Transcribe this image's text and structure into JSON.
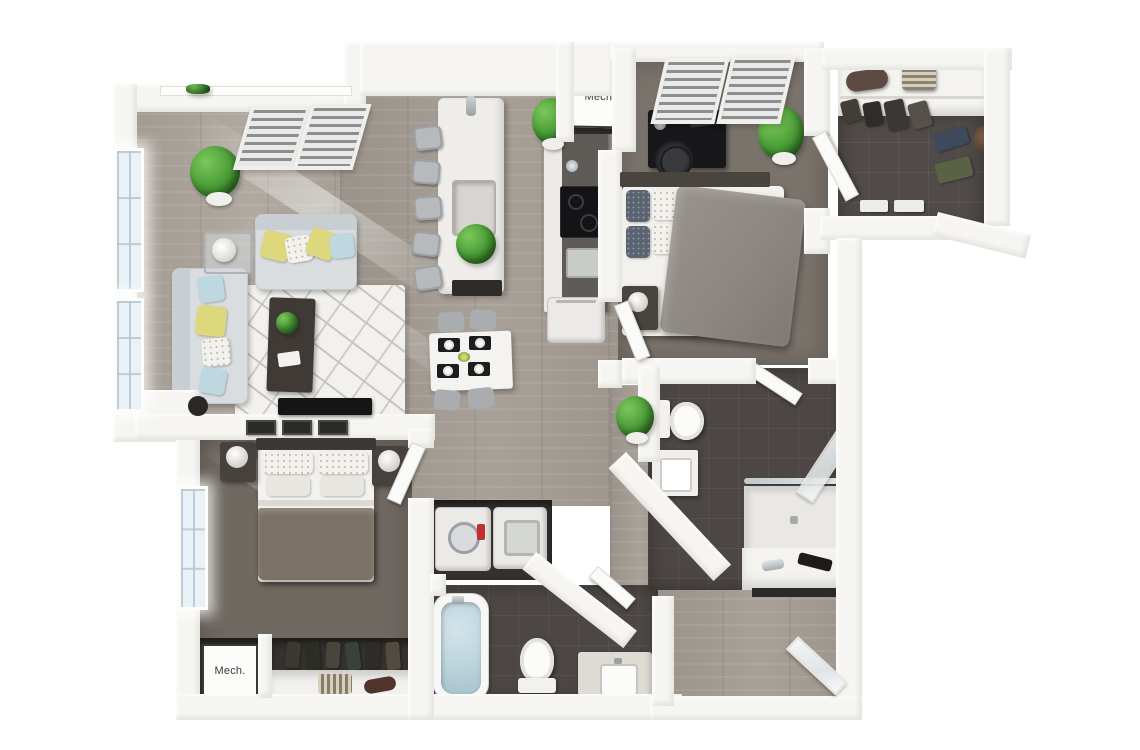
{
  "scene": {
    "kind": "3d-floor-plan-render",
    "view": "top-down dollhouse"
  },
  "labels": {
    "mech_upper": "Mech.",
    "mech_lower": "Mech."
  },
  "palette": {
    "background": "#ffffff",
    "walls": "#f6f5f2",
    "wood_floor": "#a49c93",
    "bedroom_carpet": "#746d65",
    "bathroom_tile": "#4c4744",
    "closet_niche": "#34312e",
    "sofa_gray": "#d9dde0",
    "pillow_yellow": "#ddd87c",
    "pillow_blue": "#bdd8e0",
    "plant_green": "#479a35",
    "tub_water": "#b9d2da",
    "bed_blanket_brown": "#7b7165",
    "duvet_gray": "#8d8781",
    "desk_black": "#18171a"
  },
  "rooms": [
    {
      "name": "living-room",
      "items": [
        "sofa",
        "loveseat",
        "area-rug",
        "coffee-table",
        "side-table-with-lamp",
        "tv-console",
        "potted-plant",
        "blinded-window",
        "tall-windows"
      ]
    },
    {
      "name": "kitchen",
      "items": [
        "island-with-sink",
        "island-plant",
        "five-bar-stools",
        "cooktop-counter",
        "counter-sink",
        "refrigerator",
        "potted-plant"
      ]
    },
    {
      "name": "dining-area",
      "items": [
        "table",
        "four-chairs",
        "four-place-settings",
        "centerpiece"
      ]
    },
    {
      "name": "bedroom-primary-bottom-left",
      "items": [
        "bed-with-brown-blanket",
        "two-nightstands",
        "two-lamps",
        "three-wall-frames",
        "window",
        "reach-in-closet"
      ]
    },
    {
      "name": "bedroom-top-right",
      "items": [
        "bed-with-gray-duvet",
        "desk",
        "office-chair",
        "nightstand-with-lamp",
        "blinded-window",
        "potted-plant"
      ]
    },
    {
      "name": "walk-in-closet",
      "items": [
        "hanging-clothes",
        "shelf-with-bags",
        "striped-basket",
        "storage-bins"
      ]
    },
    {
      "name": "bathroom-bottom",
      "items": [
        "bathtub",
        "toilet",
        "vanity-with-sink",
        "bath-mat"
      ]
    },
    {
      "name": "bathroom-right",
      "items": [
        "toilet",
        "vanity-with-sink",
        "walk-in-shower",
        "glass-panel"
      ]
    },
    {
      "name": "laundry-closet",
      "items": [
        "washer",
        "dryer"
      ]
    },
    {
      "name": "mechanical-closet-upper",
      "label_ref": "mech_upper"
    },
    {
      "name": "mechanical-closet-lower",
      "label_ref": "mech_lower"
    },
    {
      "name": "entry",
      "items": [
        "angled-entry-door",
        "console-shelf"
      ]
    },
    {
      "name": "hallway",
      "items": [
        "potted-plant"
      ]
    }
  ]
}
